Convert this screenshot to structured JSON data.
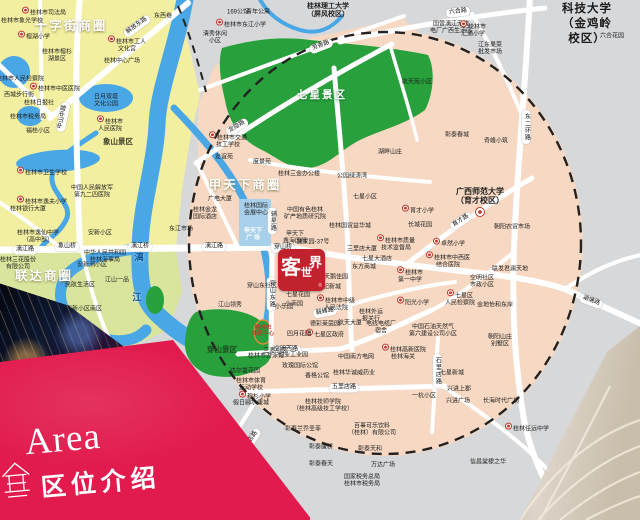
{
  "colors": {
    "bg_gray": "#d7d8da",
    "old_town_yellow": "#f3efa0",
    "south_green_yellow": "#d9e59c",
    "core_pink": "#f7d9c3",
    "park_green": "#28a03c",
    "river_blue": "#4aa7e5",
    "poi_block_blue": "#a9d0ea",
    "banner_red": "#e11b4d",
    "logo_red": "#c2222d"
  },
  "banner": {
    "title_en": "Area",
    "title_zh": "区位介绍",
    "icon": "pavilion-line-icon"
  },
  "logo": {
    "name": "客世界",
    "c1": "客",
    "c2": "世",
    "c3": "界",
    "tiny": "®"
  },
  "map": {
    "labels": [
      {
        "t": "十字街商圈",
        "x": 71,
        "y": 26,
        "k": "dist"
      },
      {
        "t": "甲天下商圈",
        "x": 245,
        "y": 185,
        "k": "dist"
      },
      {
        "t": "联达商圈",
        "x": 44,
        "y": 276,
        "k": "dist"
      },
      {
        "t": "七星景区",
        "x": 322,
        "y": 96,
        "k": "park"
      },
      {
        "t": "穿山景区",
        "x": 222,
        "y": 350,
        "k": "parkdk"
      },
      {
        "t": "象山景区",
        "x": 118,
        "y": 142,
        "k": "poiB"
      },
      {
        "t": "桂林电子科技大学\n（金鸡岭校区）",
        "x": 587,
        "y": 17,
        "k": "univL"
      },
      {
        "t": "桂林理工大学\n（屏风校区）",
        "x": 328,
        "y": 11,
        "k": "univS"
      },
      {
        "t": "广西师范大学\n（育才校区）",
        "x": 480,
        "y": 197,
        "k": "univM"
      },
      {
        "t": "",
        "x": 480,
        "y": 212,
        "k": "uicon"
      },
      {
        "t": "漓",
        "x": 139,
        "y": 259,
        "k": "riv"
      },
      {
        "t": "江",
        "x": 137,
        "y": 299,
        "k": "riv"
      },
      {
        "t": "解放东路",
        "x": 137,
        "y": 26,
        "k": "pill",
        "r": -36
      },
      {
        "t": "中山中路",
        "x": 63,
        "y": 117,
        "k": "pill",
        "r": -78
      },
      {
        "t": "六合路",
        "x": 458,
        "y": 12,
        "k": "pill",
        "r": -6
      },
      {
        "t": "芳香路",
        "x": 321,
        "y": 46,
        "k": "pill",
        "r": -21
      },
      {
        "t": "龙隐路",
        "x": 237,
        "y": 127,
        "k": "pill",
        "r": -31
      },
      {
        "t": "漓江路",
        "x": 25,
        "y": 250,
        "k": "pill"
      },
      {
        "t": "漓江路",
        "x": 214,
        "y": 247,
        "k": "pill"
      },
      {
        "t": "象山桥",
        "x": 67,
        "y": 247,
        "k": "pill"
      },
      {
        "t": "漓江桥",
        "x": 140,
        "y": 247,
        "k": "pill"
      },
      {
        "t": "穿山桥",
        "x": 283,
        "y": 248,
        "k": "pill"
      },
      {
        "t": "育才路",
        "x": 461,
        "y": 221,
        "k": "pill",
        "r": -34
      },
      {
        "t": "空明西路",
        "x": 286,
        "y": 350,
        "k": "pill"
      },
      {
        "t": "五里店路",
        "x": 344,
        "y": 388,
        "k": "pill"
      },
      {
        "t": "五里店路",
        "x": 250,
        "y": 442,
        "k": "pill",
        "r": -56
      },
      {
        "t": "毅峰路",
        "x": 325,
        "y": 312,
        "k": "pill",
        "r": -10
      },
      {
        "t": "湖塘路",
        "x": 591,
        "y": 301,
        "k": "pill",
        "r": 21
      },
      {
        "t": "穿山东路",
        "x": 271,
        "y": 294,
        "k": "pillv"
      },
      {
        "t": "辅星路",
        "x": 272,
        "y": 221,
        "k": "pillv"
      },
      {
        "t": "东二环路",
        "x": 526,
        "y": 127,
        "k": "pillv"
      },
      {
        "t": "石里店路",
        "x": 437,
        "y": 371,
        "k": "pillv"
      },
      {
        "t": "东西巷",
        "x": 163,
        "y": 17,
        "k": "poi"
      },
      {
        "t": "桂林市司法局",
        "x": 44,
        "y": 12,
        "k": "poi",
        "m": "red"
      },
      {
        "t": "桂林市象光学校",
        "x": 22,
        "y": 22,
        "k": "poi"
      },
      {
        "t": "榕湖小学",
        "x": 34,
        "y": 36,
        "k": "poi",
        "m": "red"
      },
      {
        "t": "桂林市工人\n文化宫",
        "x": 127,
        "y": 44,
        "k": "poi",
        "m": "red"
      },
      {
        "t": "桂林中心广场",
        "x": 122,
        "y": 62,
        "k": "poi"
      },
      {
        "t": "桂林市榕杉\n湖景区",
        "x": 57,
        "y": 56,
        "k": "poi"
      },
      {
        "t": "桂林市人民检察院",
        "x": 20,
        "y": 80,
        "k": "poi"
      },
      {
        "t": "桂林市中医医院",
        "x": 55,
        "y": 88,
        "k": "poi",
        "m": "red"
      },
      {
        "t": "西城步行街",
        "x": 19,
        "y": 96,
        "k": "poi"
      },
      {
        "t": "桂林日报社",
        "x": 39,
        "y": 104,
        "k": "poi"
      },
      {
        "t": "日月双塔\n文化公园",
        "x": 106,
        "y": 101,
        "k": "poi"
      },
      {
        "t": "桂林市税务局",
        "x": 28,
        "y": 118,
        "k": "poi"
      },
      {
        "t": "福桂小区",
        "x": 38,
        "y": 132,
        "k": "poi"
      },
      {
        "t": "桂林市\n人民医院",
        "x": 110,
        "y": 124,
        "k": "poi",
        "m": "red"
      },
      {
        "t": "桂林市卫生学校",
        "x": 42,
        "y": 172,
        "k": "poi",
        "m": "red"
      },
      {
        "t": "中国人民解放军\n第九二四医院",
        "x": 92,
        "y": 192,
        "k": "poi"
      },
      {
        "t": "桂林市逸夫小学",
        "x": 42,
        "y": 201,
        "k": "poi",
        "m": "red"
      },
      {
        "t": "桂林银行大厦",
        "x": 28,
        "y": 210,
        "k": "poi"
      },
      {
        "t": "桂林市逸仙中学\n（高中部）",
        "x": 38,
        "y": 237,
        "k": "poi"
      },
      {
        "t": "安新小区",
        "x": 100,
        "y": 234,
        "k": "poi"
      },
      {
        "t": "中华人民共和国\n桂林海事局",
        "x": 105,
        "y": 257,
        "k": "poi"
      },
      {
        "t": "桂林三花股份\n有限公司",
        "x": 18,
        "y": 264,
        "k": "poi"
      },
      {
        "t": "安新洲小区",
        "x": 92,
        "y": 266,
        "k": "poi"
      },
      {
        "t": "民航生活区",
        "x": 80,
        "y": 286,
        "k": "poi"
      },
      {
        "t": "江山一品",
        "x": 117,
        "y": 281,
        "k": "poi"
      },
      {
        "t": "安新小区南区",
        "x": 84,
        "y": 310,
        "k": "poi"
      },
      {
        "t": "清秀休闲\n小区",
        "x": 215,
        "y": 38,
        "k": "poi"
      },
      {
        "t": "169公馆",
        "x": 238,
        "y": 13,
        "k": "poi"
      },
      {
        "t": "青年公寓",
        "x": 258,
        "y": 13,
        "k": "poi"
      },
      {
        "t": "桂林市东江小学",
        "x": 241,
        "y": 24,
        "k": "poi",
        "m": "red"
      },
      {
        "t": "国营漓江无线\n电厂广西生活区",
        "x": 451,
        "y": 28,
        "k": "poi"
      },
      {
        "t": "桂林市\n汇通小学",
        "x": 473,
        "y": 29,
        "k": "poi",
        "m": "red"
      },
      {
        "t": "江东果菜\n批发市场",
        "x": 490,
        "y": 49,
        "k": "poi"
      },
      {
        "t": "六合花园",
        "x": 612,
        "y": 37,
        "k": "poi"
      },
      {
        "t": "航天苑小区",
        "x": 417,
        "y": 83,
        "k": "poi"
      },
      {
        "t": "桂林市交通\n技工学校",
        "x": 228,
        "y": 140,
        "k": "poi",
        "m": "red"
      },
      {
        "t": "友谊苑",
        "x": 224,
        "y": 158,
        "k": "poi"
      },
      {
        "t": "度景苑",
        "x": 262,
        "y": 163,
        "k": "poi"
      },
      {
        "t": "桂林三金办公楼",
        "x": 299,
        "y": 175,
        "k": "poi"
      },
      {
        "t": "湖畔山庄",
        "x": 390,
        "y": 153,
        "k": "poi"
      },
      {
        "t": "彰泰春城",
        "x": 457,
        "y": 136,
        "k": "poi"
      },
      {
        "t": "奇峰小筑",
        "x": 496,
        "y": 142,
        "k": "poi"
      },
      {
        "t": "公园绿涛湾",
        "x": 352,
        "y": 177,
        "k": "poi"
      },
      {
        "t": "七星小区",
        "x": 365,
        "y": 198,
        "k": "poi"
      },
      {
        "t": "广电大厦",
        "x": 220,
        "y": 200,
        "k": "poi"
      },
      {
        "t": "桂林金龙\n国际酒店",
        "x": 205,
        "y": 214,
        "k": "poi"
      },
      {
        "t": "东江市场",
        "x": 181,
        "y": 230,
        "k": "poi"
      },
      {
        "t": "桂林国际\n会展中心",
        "x": 256,
        "y": 210,
        "k": "poi"
      },
      {
        "t": "甲天下\n广  场",
        "x": 253,
        "y": 235,
        "k": "poiw"
      },
      {
        "t": "中国有色桂林\n矿产地质研究院",
        "x": 305,
        "y": 214,
        "k": "poi"
      },
      {
        "t": "桂林国贸益华城",
        "x": 350,
        "y": 227,
        "k": "poi"
      },
      {
        "t": "甲天下\n鑫海国际",
        "x": 295,
        "y": 238,
        "k": "poi"
      },
      {
        "t": "施家园-37号",
        "x": 313,
        "y": 243,
        "k": "poi"
      },
      {
        "t": "穿山东社区",
        "x": 262,
        "y": 287,
        "k": "poi"
      },
      {
        "t": "七星花园",
        "x": 298,
        "y": 296,
        "k": "poi"
      },
      {
        "t": "小乐园",
        "x": 284,
        "y": 308,
        "k": "poi"
      },
      {
        "t": "三里店大厦",
        "x": 362,
        "y": 250,
        "k": "poi"
      },
      {
        "t": "七星大酒店",
        "x": 377,
        "y": 260,
        "k": "poi"
      },
      {
        "t": "东方商城",
        "x": 364,
        "y": 268,
        "k": "poi"
      },
      {
        "t": "天鹅佳园",
        "x": 336,
        "y": 278,
        "k": "poi"
      },
      {
        "t": "世纪新城",
        "x": 329,
        "y": 288,
        "k": "poi"
      },
      {
        "t": "桂林市中级\n人民法院",
        "x": 336,
        "y": 303,
        "k": "poi",
        "m": "red"
      },
      {
        "t": "桂林市\n第一中学",
        "x": 410,
        "y": 275,
        "k": "poi",
        "m": "red"
      },
      {
        "t": "育才小学",
        "x": 418,
        "y": 210,
        "k": "poi",
        "m": "red"
      },
      {
        "t": "长城花园",
        "x": 420,
        "y": 226,
        "k": "poi"
      },
      {
        "t": "桂林市质量\n技术监督局",
        "x": 396,
        "y": 243,
        "k": "poi",
        "m": "red"
      },
      {
        "t": "卓然小学",
        "x": 449,
        "y": 243,
        "k": "poi",
        "m": "red"
      },
      {
        "t": "桂林市中西医\n结合医院",
        "x": 448,
        "y": 260,
        "k": "poi",
        "m": "red"
      },
      {
        "t": "朝阳农贸市场",
        "x": 512,
        "y": 228,
        "k": "poi"
      },
      {
        "t": "联发君澜天地",
        "x": 510,
        "y": 270,
        "k": "poi"
      },
      {
        "t": "空明社区\n市政小区",
        "x": 482,
        "y": 282,
        "k": "poi"
      },
      {
        "t": "七星区\n人民检察院",
        "x": 460,
        "y": 298,
        "k": "poi",
        "m": "red"
      },
      {
        "t": "金地怡和东岸",
        "x": 495,
        "y": 306,
        "k": "poi"
      },
      {
        "t": "阳光小学",
        "x": 413,
        "y": 302,
        "k": "poi",
        "m": "red"
      },
      {
        "t": "桂林外运\n报关行",
        "x": 371,
        "y": 316,
        "k": "poi"
      },
      {
        "t": "航天大厦",
        "x": 350,
        "y": 324,
        "k": "poi"
      },
      {
        "t": "七星区政府",
        "x": 325,
        "y": 334,
        "k": "poi",
        "m": "red"
      },
      {
        "t": "电线电缆厂\n宿舍",
        "x": 381,
        "y": 328,
        "k": "poi"
      },
      {
        "t": "桂林高新医院",
        "x": 404,
        "y": 349,
        "k": "poi",
        "m": "red"
      },
      {
        "t": "中国石油天然气\n第六建设公司小区",
        "x": 433,
        "y": 331,
        "k": "poi"
      },
      {
        "t": "朝阳山庄\n别墅区",
        "x": 500,
        "y": 341,
        "k": "poi"
      },
      {
        "t": "中国南方电网",
        "x": 356,
        "y": 358,
        "k": "poi"
      },
      {
        "t": "桂林海关",
        "x": 403,
        "y": 358,
        "k": "poi"
      },
      {
        "t": "桂林华诚威药业",
        "x": 354,
        "y": 374,
        "k": "poi"
      },
      {
        "t": "香格公馆",
        "x": 317,
        "y": 377,
        "k": "poi"
      },
      {
        "t": "玫瑰国际公馆",
        "x": 300,
        "y": 367,
        "k": "poi"
      },
      {
        "t": "三潭小区",
        "x": 275,
        "y": 352,
        "k": "poi"
      },
      {
        "t": "创业工业园",
        "x": 293,
        "y": 356,
        "k": "poi"
      },
      {
        "t": "小南园",
        "x": 294,
        "y": 305,
        "k": "poi"
      },
      {
        "t": "江山领秀",
        "x": 230,
        "y": 306,
        "k": "poi"
      },
      {
        "t": "德彩莱茵园",
        "x": 325,
        "y": 325,
        "k": "poi"
      },
      {
        "t": "四月花园",
        "x": 299,
        "y": 335,
        "k": "poi"
      },
      {
        "t": "桂林市\n体育中心",
        "x": 263,
        "y": 331,
        "k": "red"
      },
      {
        "t": "桂林市游泳馆",
        "x": 266,
        "y": 357,
        "k": "poi"
      },
      {
        "t": "达尔曼花园",
        "x": 245,
        "y": 372,
        "k": "poi"
      },
      {
        "t": "桂林市体育\n运动学校",
        "x": 251,
        "y": 385,
        "k": "poi"
      },
      {
        "t": "穆杉小学",
        "x": 255,
        "y": 396,
        "k": "poi",
        "m": "red"
      },
      {
        "t": "假日郦水康城",
        "x": 251,
        "y": 404,
        "k": "poi"
      },
      {
        "t": "桂林技师学院\n（桂林高级技工学校）",
        "x": 323,
        "y": 406,
        "k": "poi"
      },
      {
        "t": "百事可乐饮料\n（桂林）有限公司",
        "x": 372,
        "y": 430,
        "k": "poi"
      },
      {
        "t": "彰泰兰乔圣菲",
        "x": 303,
        "y": 430,
        "k": "poi"
      },
      {
        "t": "彰泰康桥",
        "x": 321,
        "y": 448,
        "k": "poi"
      },
      {
        "t": "彰泰春天",
        "x": 321,
        "y": 465,
        "k": "poi"
      },
      {
        "t": "彰泰天和",
        "x": 370,
        "y": 450,
        "k": "poi"
      },
      {
        "t": "万达广场",
        "x": 383,
        "y": 466,
        "k": "poi"
      },
      {
        "t": "国家税务总局\n桂林市税务局",
        "x": 362,
        "y": 481,
        "k": "poi"
      },
      {
        "t": "一杭小区",
        "x": 424,
        "y": 397,
        "k": "poi"
      },
      {
        "t": "七星新城",
        "x": 452,
        "y": 374,
        "k": "poi"
      },
      {
        "t": "兴进上郡",
        "x": 459,
        "y": 390,
        "k": "poi"
      },
      {
        "t": "兴进广场",
        "x": 458,
        "y": 402,
        "k": "poi"
      },
      {
        "t": "长海时代广场",
        "x": 501,
        "y": 402,
        "k": "poi"
      },
      {
        "t": "桂林任远中学",
        "x": 527,
        "y": 428,
        "k": "poi",
        "m": "red"
      },
      {
        "t": "信昌棠棣之华",
        "x": 488,
        "y": 463,
        "k": "poi"
      }
    ]
  }
}
